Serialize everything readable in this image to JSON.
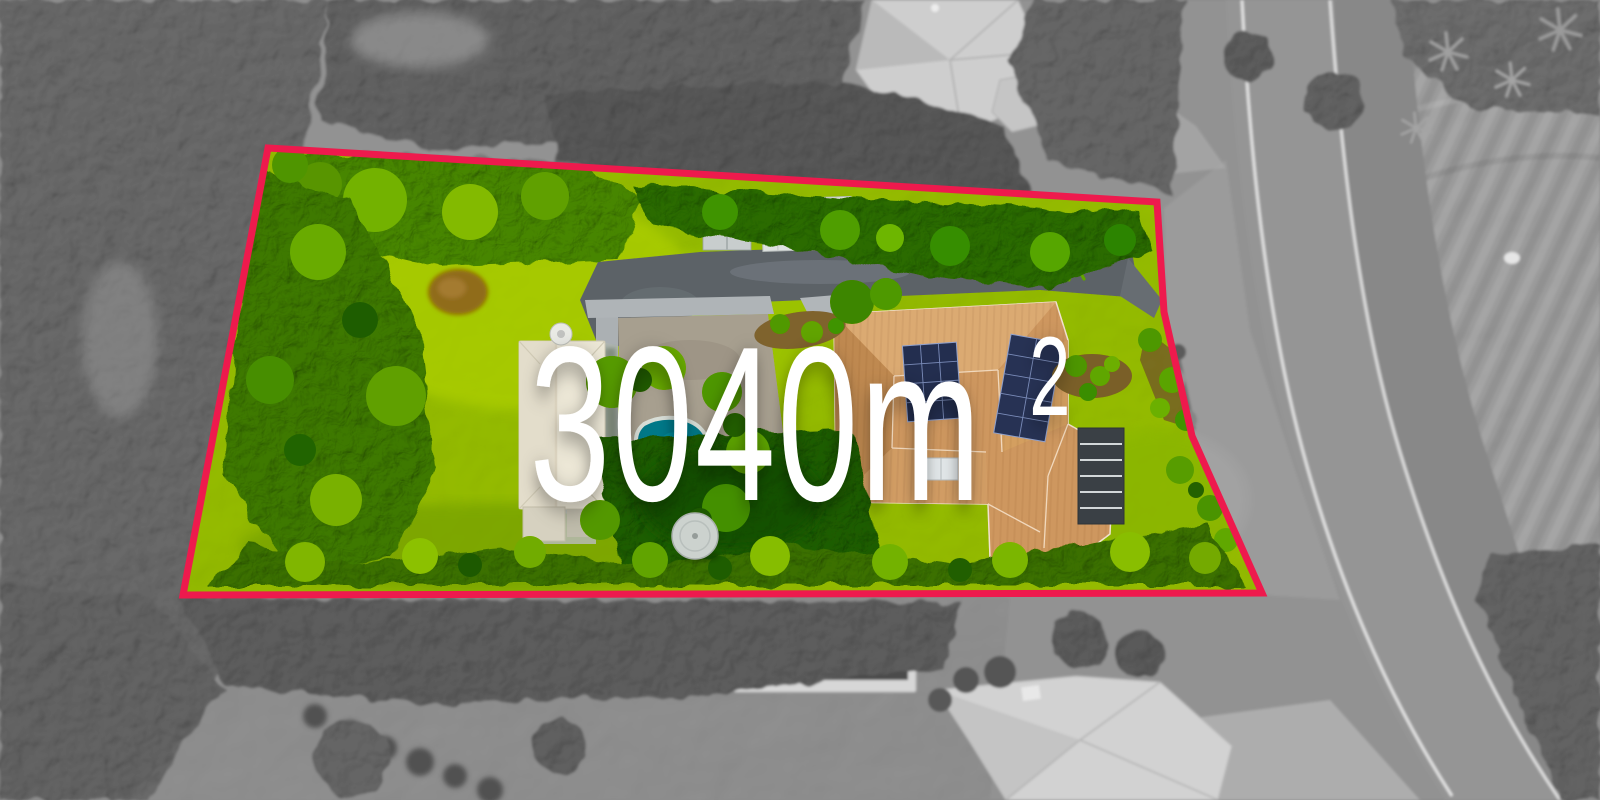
{
  "overlay": {
    "area_text": "3040m",
    "area_superscript": "2",
    "area_label_full": "3040m²"
  },
  "colors": {
    "boundary": "#ee1a4d",
    "label": "#ffffff"
  }
}
